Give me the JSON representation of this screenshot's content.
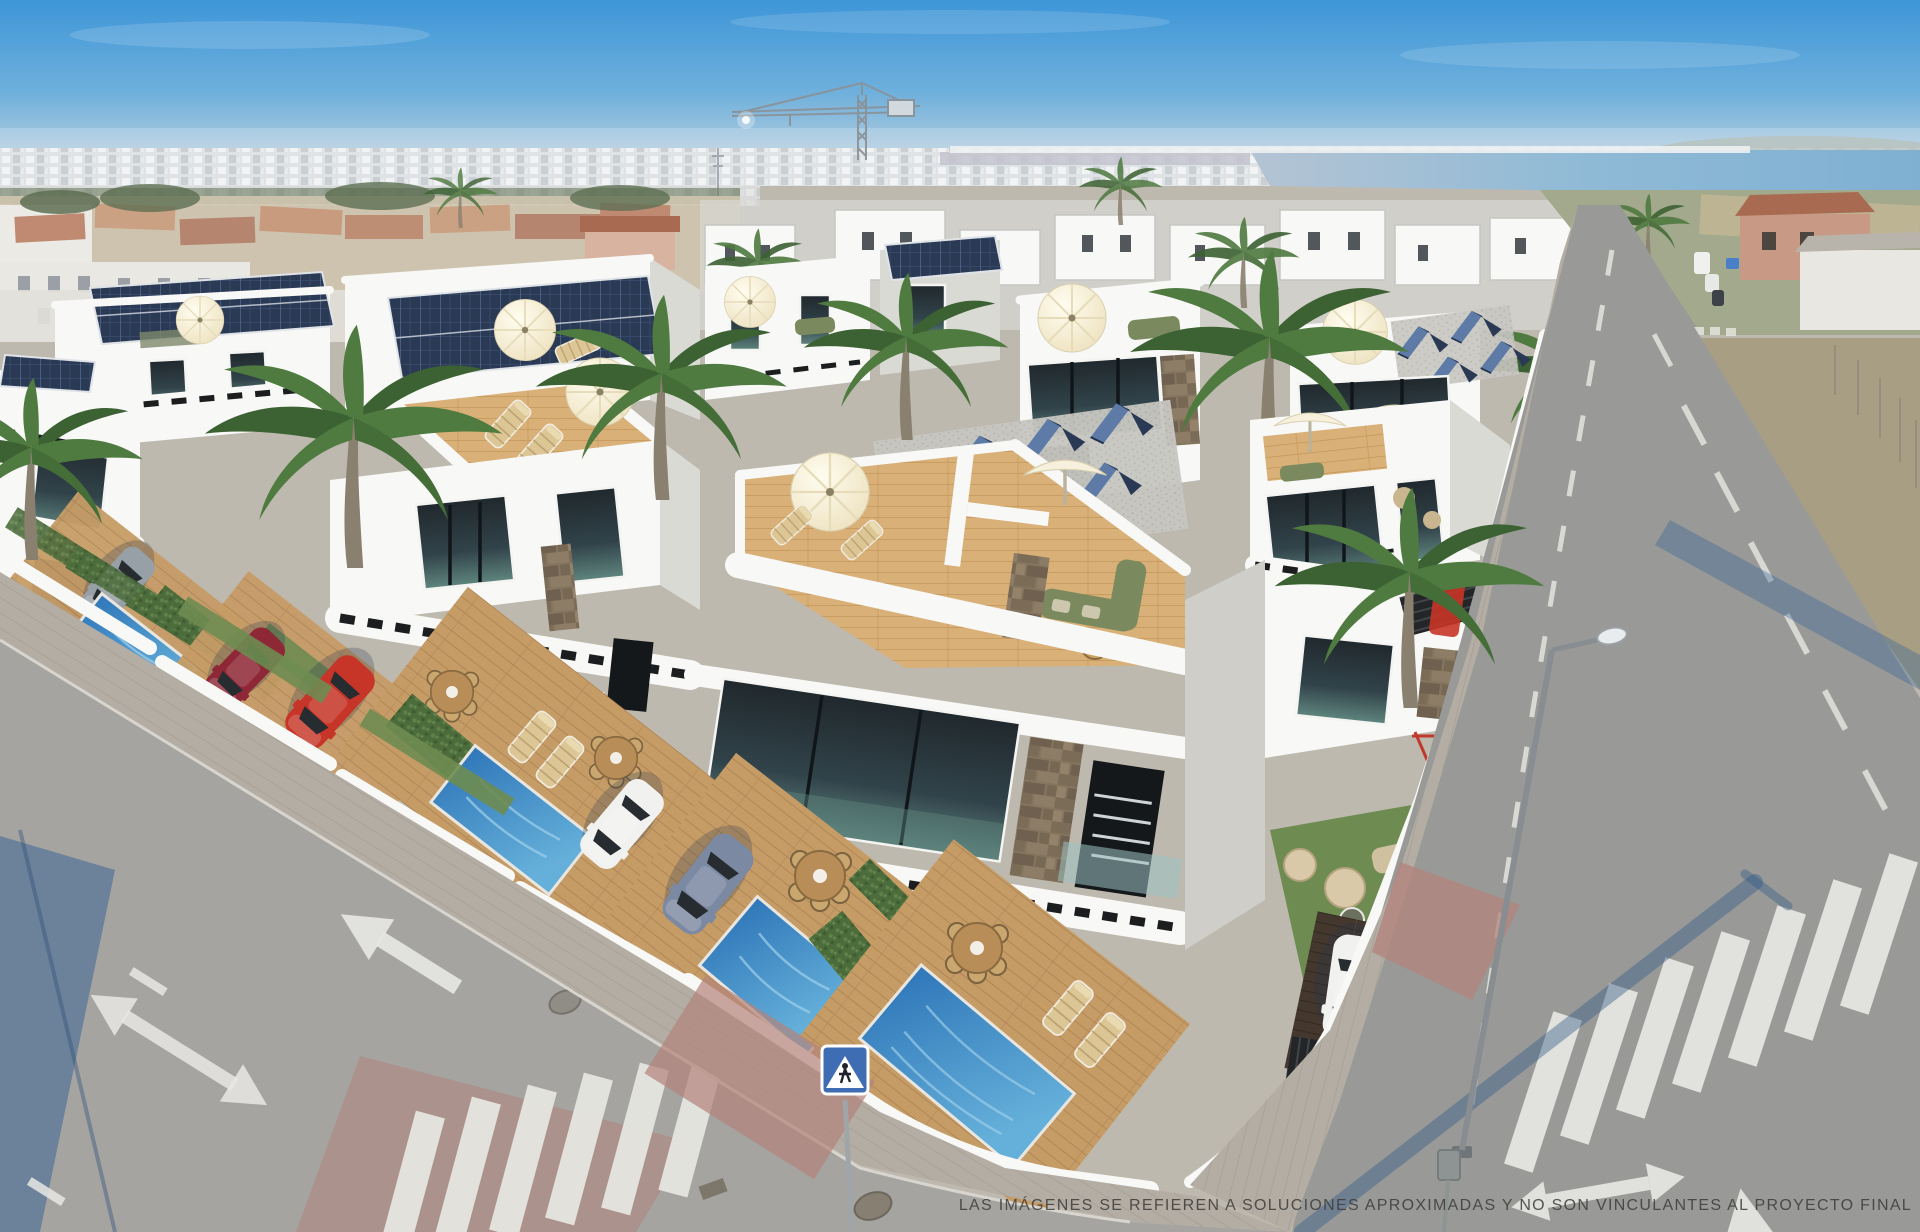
{
  "meta": {
    "type": "architectural-render",
    "width": 1920,
    "height": 1232
  },
  "caption": {
    "disclaimer": "LAS IMÁGENES SE REFIEREN A SOLUCIONES APROXIMADAS Y NO SON VINCULANTES AL PROYECTO FINAL"
  },
  "scene": {
    "description": "Aerial 3D render of a new development of modern white two-storey villas with private pools, wooden decks, rooftop terraces and solar panels, at a sunny coastal street corner",
    "sky": "clear blue with light haze at the horizon",
    "background": [
      "distant white cityscape along the horizon",
      "coastal lagoon and shoreline at upper right",
      "tower crane above the skyline",
      "older beige villas with terracotta roofs behind the development",
      "green fields and scrubland beside the right-hand road"
    ],
    "development_features": [
      "rooftop terraces with cream parasols and olive-green lounge sofas",
      "photovoltaic panels flat and A-frame on the roofs",
      "white balcony parapets with dark slot openings",
      "dark glazed windows and stone-clad accent walls",
      "private pools with wooden decks and hedges between gardens",
      "sun loungers and round rattan dining sets"
    ],
    "vehicles": [
      {
        "name": "grey hatchback",
        "color_key": "car_gray"
      },
      {
        "name": "dark red coupe",
        "color_key": "car_darkred"
      },
      {
        "name": "red crossover",
        "color_key": "car_red"
      },
      {
        "name": "white saloon",
        "color_key": "car_white"
      },
      {
        "name": "blue-grey coupe",
        "color_key": "car_blue"
      },
      {
        "name": "white SUV on dark timber drive",
        "color_key": "car_white"
      },
      {
        "name": "distant parked van and cars at the top junction",
        "color_key": "car_white"
      }
    ],
    "streets": {
      "left_road_markings": [
        "straight-ahead arrow",
        "double direction arrow",
        "lane dashes",
        "zebra crossing on red patch",
        "manhole covers",
        "long cable shadow"
      ],
      "right_road_markings": [
        "centre dashed line",
        "parking bay ticks",
        "double left-right arrow",
        "arrow head near bottom edge",
        "zebra crossing",
        "distant junction crossing"
      ],
      "street_furniture": [
        "street lamp with long shadow",
        "back of a traffic sign",
        "pedestrian crossing sign on pole"
      ]
    },
    "vegetation": [
      "tall fan palms by the pavements",
      "small palms on the skyline",
      "clipped hedges",
      "lawn strips"
    ]
  },
  "palette": {
    "sky_top": "#3e96d8",
    "sky_horizon": "#cfdbe3",
    "sea": "#8fbad6",
    "city": "#dfe3e5",
    "white_sun": "#f8f8f6",
    "white_shade": "#dadad5",
    "stone": "#84755f",
    "solar": "#2b3a54",
    "solar_lit": "#5d7ba6",
    "deck": "#c69c66",
    "deck_light": "#d9b077",
    "pool": "#2f77b9",
    "pool_light": "#65b0da",
    "hedge": "#4c6c3c",
    "lawn": "#6e8c51",
    "palm": "#4f7a40",
    "trunk": "#8a8070",
    "road": "#a5a4a1",
    "sidewalk": "#b3ada3",
    "sidewalk_red": "#b3837b",
    "marking": "#e8e8e3",
    "car_red": "#c63527",
    "car_darkred": "#8e2836",
    "car_gray": "#97a0a6",
    "car_blue": "#7c89a3",
    "car_white": "#f1f1ef",
    "shadow_blue": "#2f5f94",
    "umbrella": "#f7f0dd",
    "sofa_green": "#7b8a5e",
    "sign_blue": "#3f6db3",
    "crane_gray": "#8a9298",
    "text": "#3f3f3d"
  }
}
